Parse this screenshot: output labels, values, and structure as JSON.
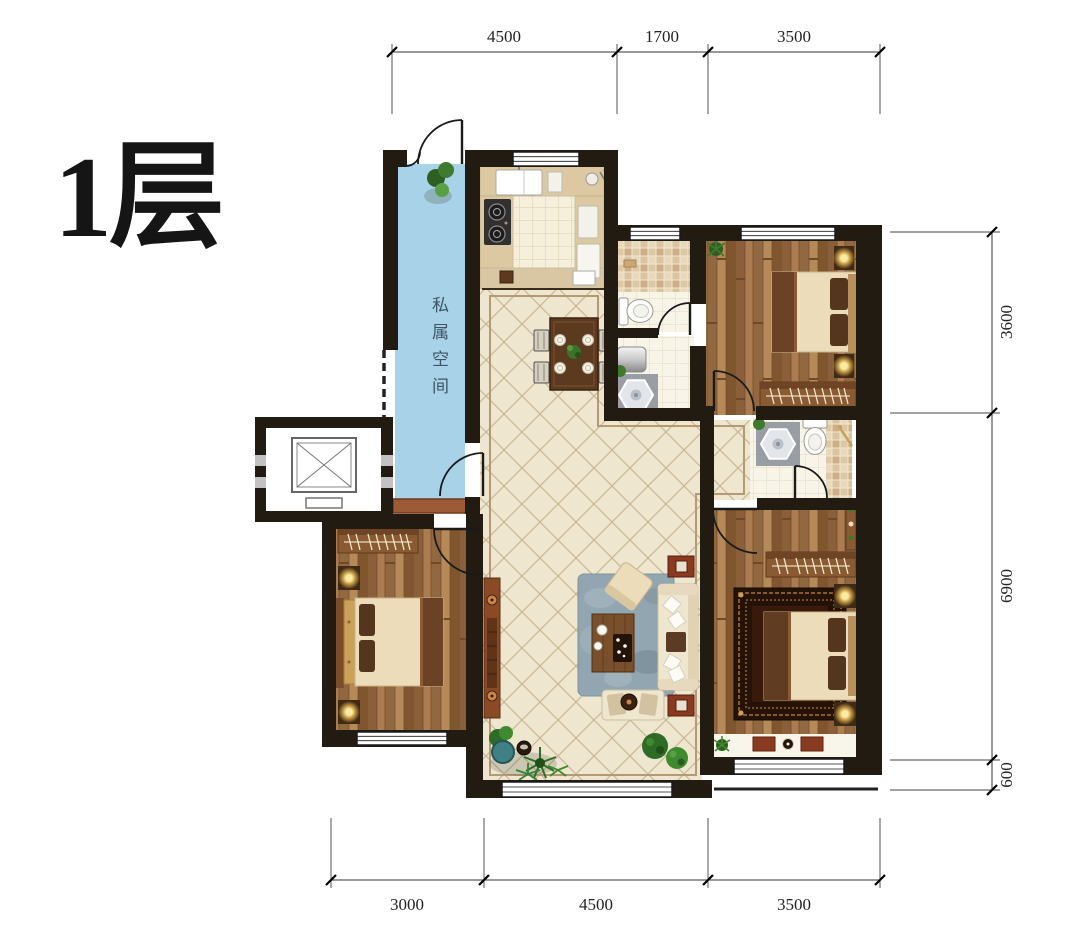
{
  "title": "1层",
  "plan": {
    "private_space_label": "私属空间",
    "dimensions": {
      "top": [
        "4500",
        "1700",
        "3500"
      ],
      "right": [
        "3600",
        "6900",
        "600"
      ],
      "bottom": [
        "3000",
        "4500",
        "3500"
      ]
    }
  },
  "colors": {
    "private_space": "#a7d2e8",
    "wall": "#221b12",
    "wood_floor": "#9c7148",
    "tile_floor": "#efe6d0",
    "trim": "#b49a74",
    "living_rug": "#92a6b1",
    "lamp_glow": "#f6d97e"
  }
}
